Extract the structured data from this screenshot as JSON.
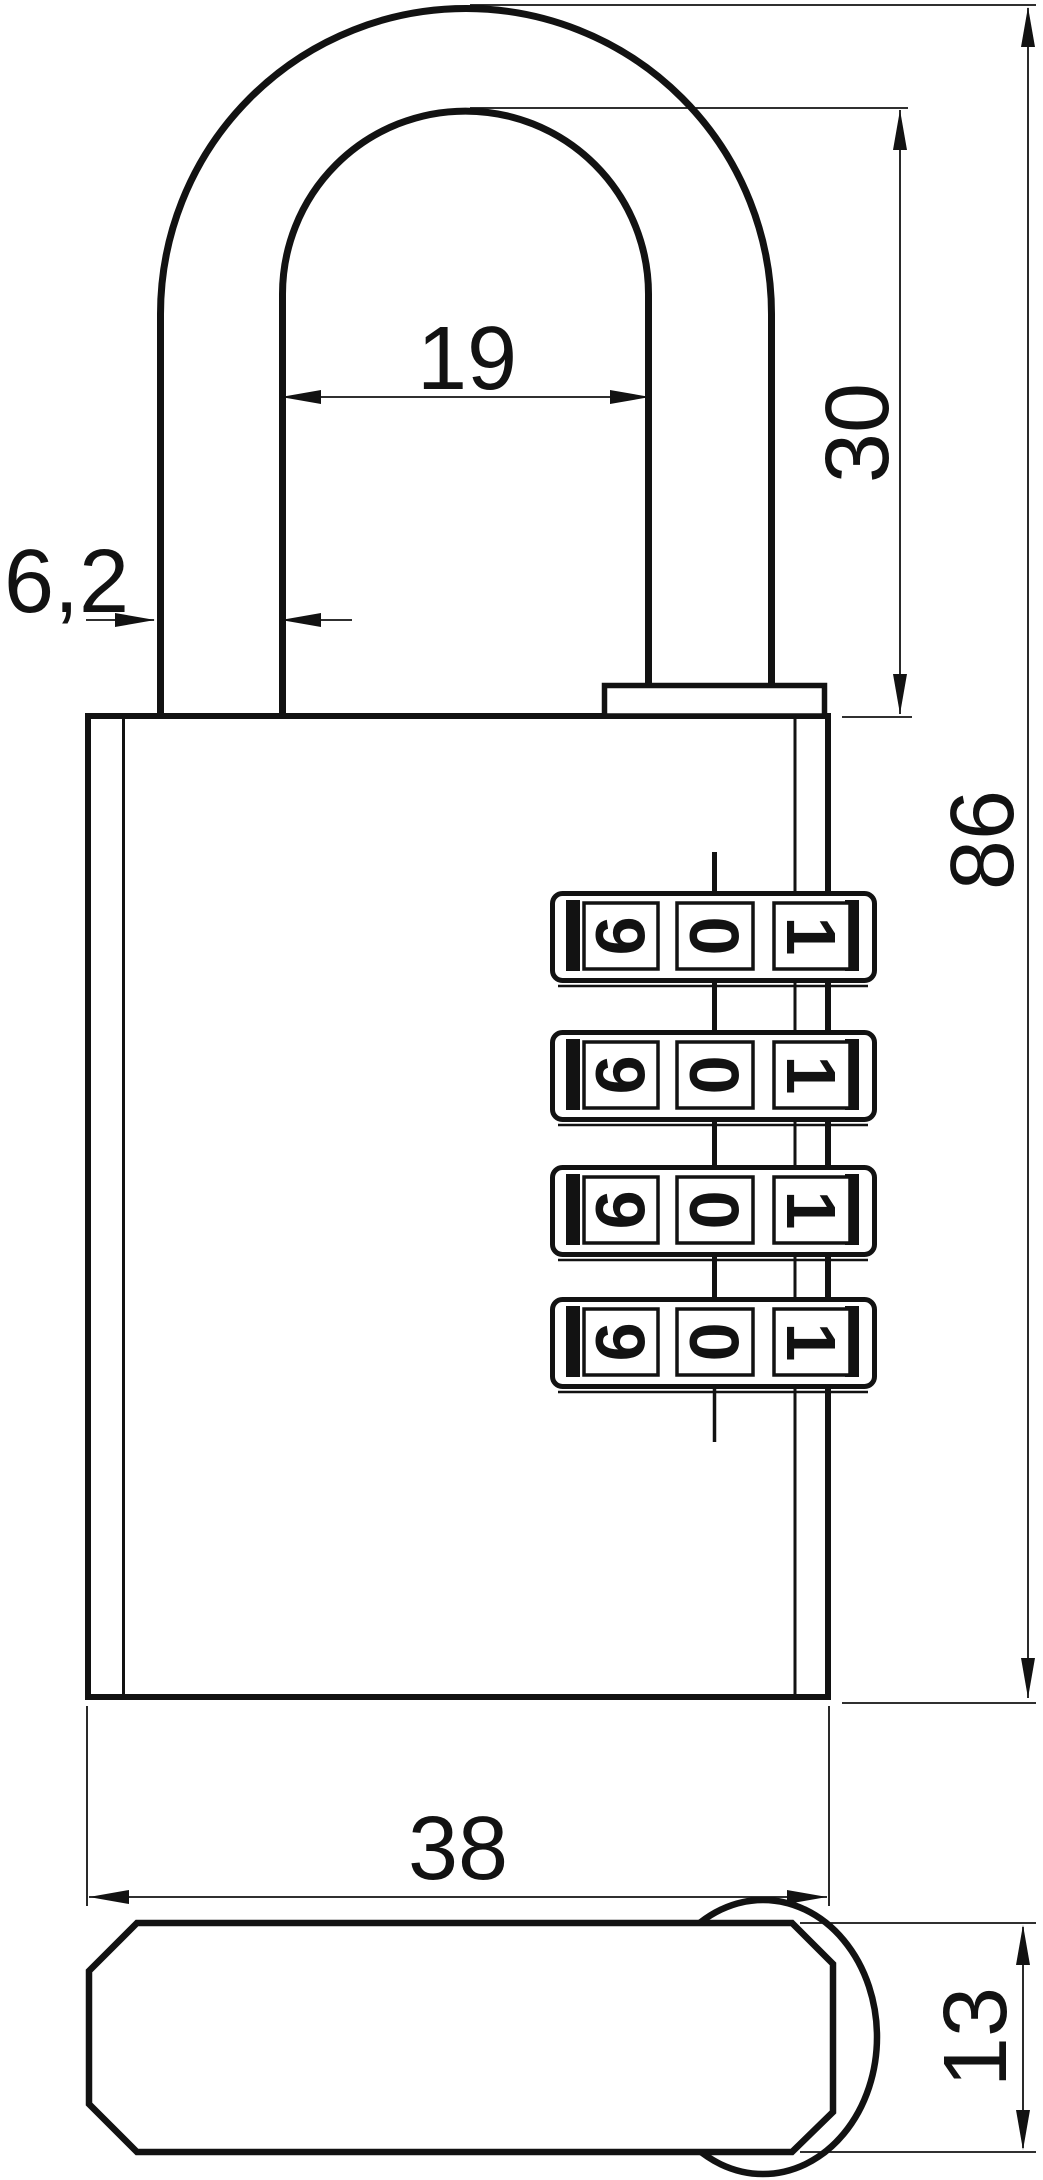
{
  "dimensions": {
    "shackle_inner_width": "19",
    "shackle_height": "30",
    "shackle_diameter": "6,2",
    "overall_height": "86",
    "body_width": "38",
    "body_depth": "13"
  },
  "dials": {
    "rows": [
      {
        "digits": [
          "9",
          "0",
          "1"
        ]
      },
      {
        "digits": [
          "9",
          "0",
          "1"
        ]
      },
      {
        "digits": [
          "9",
          "0",
          "1"
        ]
      },
      {
        "digits": [
          "9",
          "0",
          "1"
        ]
      }
    ]
  },
  "colors": {
    "line": "#121212",
    "background": "#ffffff"
  }
}
